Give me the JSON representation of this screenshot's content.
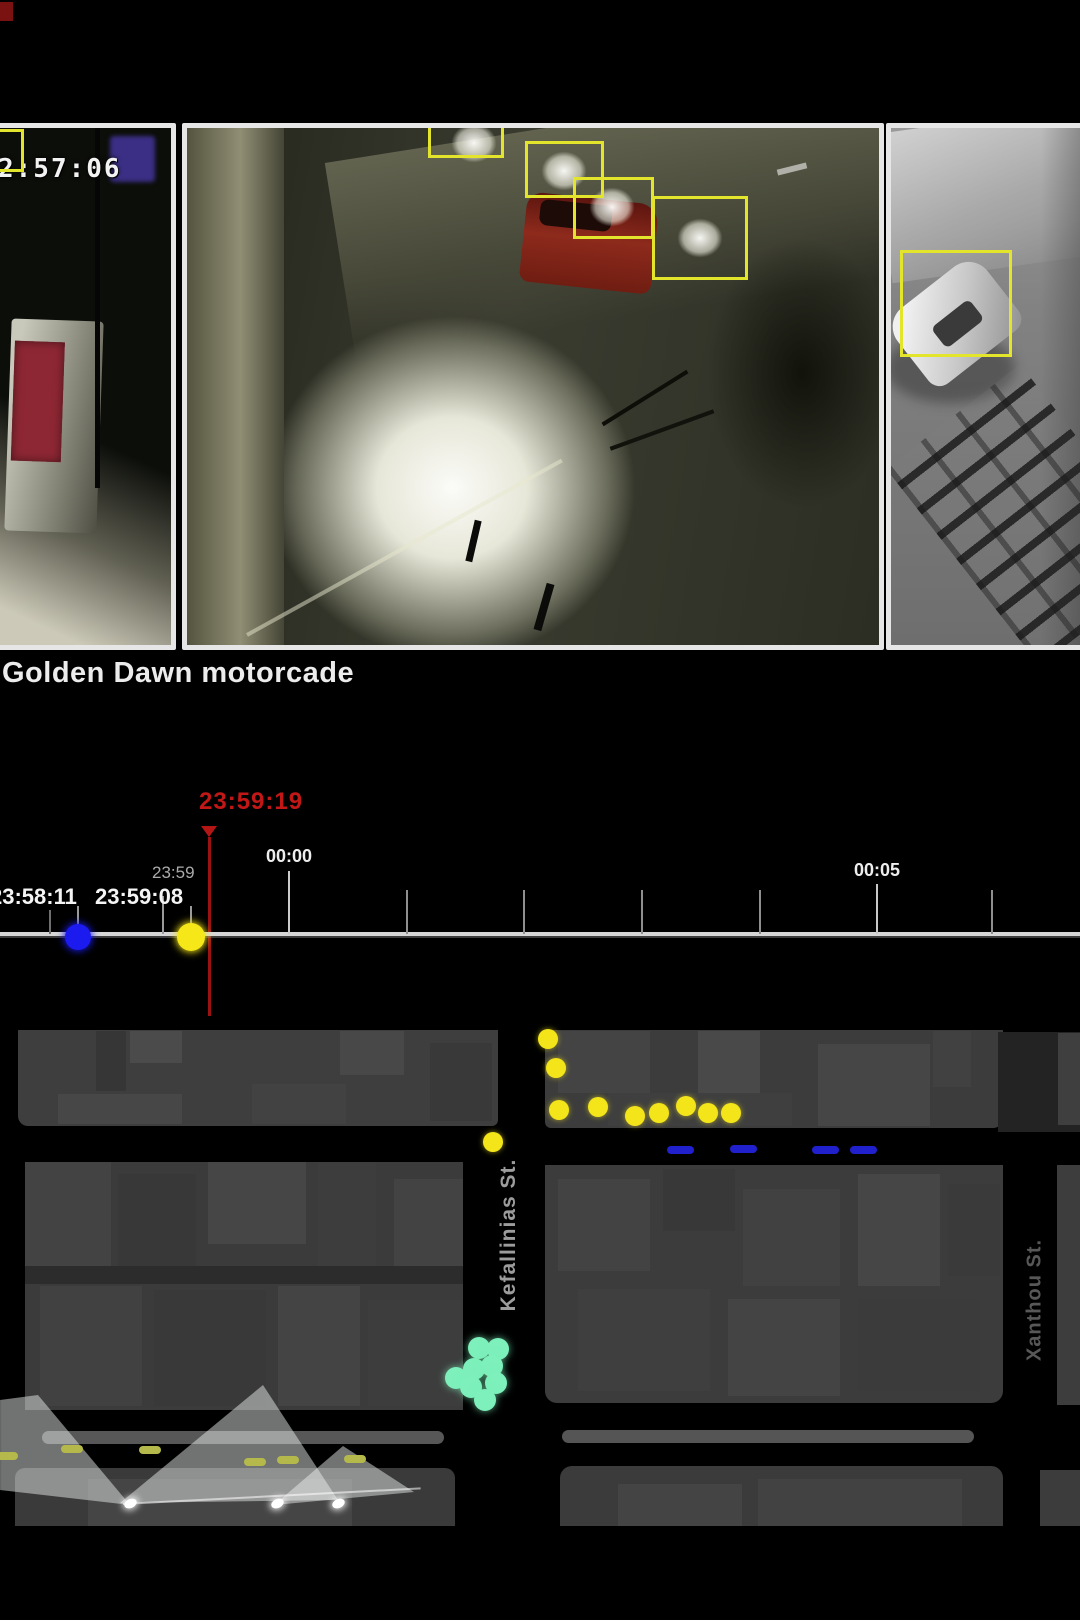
{
  "colors": {
    "detection_box": "#e3e42c",
    "cursor_red": "#c21717",
    "timeline_line": "#d6d6d6",
    "event_blue": "#1b1bf0",
    "event_yellow": "#f5e718",
    "map_yellow": "#f3e51a",
    "map_blue_dash": "#2020cc",
    "map_green": "#7df0bb",
    "map_olive_dash": "#b5b94c"
  },
  "video_strip": {
    "caption": "Golden Dawn motorcade",
    "frames": [
      {
        "name": "cctv-frame-1",
        "rect": [
          -10,
          123,
          186,
          527
        ],
        "timestamp_overlay": "2:57:06",
        "boxes": [
          {
            "x": -36,
            "y": 129,
            "w": 60,
            "h": 43
          }
        ]
      },
      {
        "name": "cctv-frame-2",
        "rect": [
          182,
          123,
          702,
          527
        ],
        "timestamp_overlay": "",
        "boxes": [
          {
            "x": 428,
            "y": 116,
            "w": 76,
            "h": 42
          },
          {
            "x": 525,
            "y": 141,
            "w": 79,
            "h": 57
          },
          {
            "x": 573,
            "y": 177,
            "w": 81,
            "h": 62
          },
          {
            "x": 652,
            "y": 196,
            "w": 96,
            "h": 84
          }
        ]
      },
      {
        "name": "cctv-frame-3",
        "rect": [
          886,
          123,
          200,
          527
        ],
        "timestamp_overlay": "",
        "boxes": [
          {
            "x": 900,
            "y": 250,
            "w": 112,
            "h": 107
          }
        ]
      }
    ]
  },
  "timeline": {
    "cursor_time": "23:59:19",
    "cursor_x": 209,
    "cursor_text_left": 199,
    "cursor_text_top": 788,
    "cursor_tri_left": 201,
    "cursor_tri_top": 826,
    "cursor_line_top": 837,
    "cursor_line_bottom": 1016,
    "minor_label": {
      "text": "23:59",
      "left": 152,
      "top": 863
    },
    "axis_labels": [
      {
        "text": "00:00",
        "x": 289,
        "top": 846
      },
      {
        "text": "00:05",
        "x": 877,
        "top": 860
      }
    ],
    "ticks": [
      {
        "x": 50,
        "top": 910,
        "h": 24,
        "c": "#6f6f6f"
      },
      {
        "x": 163,
        "top": 896,
        "h": 38,
        "c": "#9a9a9a"
      },
      {
        "x": 289,
        "top": 871,
        "h": 63,
        "c": "#cccccc"
      },
      {
        "x": 407,
        "top": 890,
        "h": 44,
        "c": "#8f8f8f"
      },
      {
        "x": 524,
        "top": 890,
        "h": 44,
        "c": "#8f8f8f"
      },
      {
        "x": 642,
        "top": 890,
        "h": 44,
        "c": "#8f8f8f"
      },
      {
        "x": 760,
        "top": 890,
        "h": 44,
        "c": "#8f8f8f"
      },
      {
        "x": 877,
        "top": 884,
        "h": 50,
        "c": "#c8c8c8"
      },
      {
        "x": 992,
        "top": 890,
        "h": 44,
        "c": "#8f8f8f"
      }
    ],
    "events": [
      {
        "time": "23:58:11",
        "label_left": -10,
        "label_top": 884,
        "conn_x": 77,
        "dot_cx": 78,
        "dot_cy": 937,
        "dot_r": 13,
        "color": "#1b1bf0"
      },
      {
        "time": "23:59:08",
        "label_left": 95,
        "label_top": 884,
        "conn_x": 190,
        "dot_cx": 191,
        "dot_cy": 937,
        "dot_r": 14,
        "color": "#f5e718"
      }
    ]
  },
  "map": {
    "street_labels": [
      {
        "text": "Kefallinias St.",
        "x": 509,
        "y": 1235,
        "color": "#9c9c9c",
        "size": 21
      },
      {
        "text": "Xanthou St.",
        "x": 1035,
        "y": 1300,
        "color": "#585858",
        "size": 20
      }
    ],
    "buildings": [
      [
        18,
        1030,
        480,
        96,
        "#3e3e3e",
        "0 0 6px 10px"
      ],
      [
        96,
        1031,
        30,
        60,
        "#363636"
      ],
      [
        130,
        1031,
        52,
        32,
        "#4b4b4b"
      ],
      [
        340,
        1031,
        64,
        44,
        "#484848"
      ],
      [
        58,
        1094,
        124,
        30,
        "#474747"
      ],
      [
        252,
        1084,
        94,
        40,
        "#424242"
      ],
      [
        430,
        1043,
        62,
        78,
        "#393939"
      ],
      [
        545,
        1030,
        458,
        98,
        "#3c3c3c",
        "0 0 10px 6px"
      ],
      [
        558,
        1031,
        92,
        62,
        "#444444"
      ],
      [
        698,
        1031,
        62,
        72,
        "#494949"
      ],
      [
        818,
        1044,
        112,
        82,
        "#464646"
      ],
      [
        933,
        1031,
        38,
        56,
        "#414141"
      ],
      [
        608,
        1093,
        184,
        33,
        "#3f3f3f"
      ],
      [
        998,
        1032,
        82,
        100,
        "trees"
      ],
      [
        1058,
        1033,
        22,
        92,
        "#3f3f3f"
      ],
      [
        25,
        1162,
        438,
        248,
        "#3b3b3b",
        "10px 0 0 0"
      ],
      [
        25,
        1162,
        86,
        106,
        "#434343"
      ],
      [
        118,
        1174,
        78,
        94,
        "#383838"
      ],
      [
        208,
        1162,
        98,
        82,
        "#464646"
      ],
      [
        318,
        1162,
        58,
        106,
        "#3d3d3d"
      ],
      [
        394,
        1179,
        69,
        88,
        "#434343"
      ],
      [
        25,
        1266,
        438,
        18,
        "#2c2c2c"
      ],
      [
        40,
        1286,
        102,
        120,
        "#414141"
      ],
      [
        154,
        1290,
        112,
        116,
        "#393939"
      ],
      [
        278,
        1286,
        82,
        120,
        "#444444"
      ],
      [
        368,
        1300,
        95,
        106,
        "#3d3d3d"
      ],
      [
        545,
        1165,
        458,
        238,
        "#3c3c3c",
        "0 0 12px 12px"
      ],
      [
        558,
        1179,
        92,
        92,
        "#434343"
      ],
      [
        663,
        1169,
        72,
        62,
        "#383838"
      ],
      [
        743,
        1189,
        97,
        97,
        "#414141"
      ],
      [
        858,
        1174,
        82,
        112,
        "#464646"
      ],
      [
        948,
        1184,
        52,
        92,
        "#3a3a3a"
      ],
      [
        578,
        1289,
        132,
        102,
        "#3f3f3f"
      ],
      [
        728,
        1299,
        112,
        97,
        "#444444"
      ],
      [
        858,
        1299,
        122,
        92,
        "#3b3b3b"
      ],
      [
        1057,
        1165,
        23,
        240,
        "#3d3d3d"
      ],
      [
        15,
        1468,
        440,
        58,
        "#3a3a3a",
        "10px 10px 0 0"
      ],
      [
        88,
        1479,
        264,
        47,
        "#454545"
      ],
      [
        560,
        1466,
        443,
        60,
        "#3b3b3b",
        "12px 12px 0 0"
      ],
      [
        618,
        1484,
        124,
        42,
        "#444444"
      ],
      [
        758,
        1479,
        204,
        47,
        "#424242"
      ],
      [
        1040,
        1470,
        40,
        56,
        "#3c3c3c"
      ]
    ],
    "medians": [
      [
        42,
        1431,
        402,
        13,
        "#575757"
      ],
      [
        562,
        1430,
        412,
        13,
        "#555555"
      ]
    ],
    "yellow_dots": [
      [
        548,
        1039
      ],
      [
        556,
        1068
      ],
      [
        559,
        1110
      ],
      [
        598,
        1107
      ],
      [
        635,
        1116
      ],
      [
        659,
        1113
      ],
      [
        686,
        1106
      ],
      [
        708,
        1113
      ],
      [
        731,
        1113
      ],
      [
        493,
        1142
      ]
    ],
    "blue_dashes": [
      [
        667,
        1146
      ],
      [
        730,
        1145
      ],
      [
        812,
        1146
      ],
      [
        850,
        1146
      ]
    ],
    "green_dots": [
      [
        479,
        1348
      ],
      [
        498,
        1349
      ],
      [
        474,
        1369
      ],
      [
        492,
        1366
      ],
      [
        456,
        1378
      ],
      [
        496,
        1383
      ],
      [
        471,
        1387
      ],
      [
        485,
        1400
      ]
    ],
    "olive_dashes": [
      [
        -4,
        1452
      ],
      [
        61,
        1445
      ],
      [
        139,
        1446
      ],
      [
        244,
        1458
      ],
      [
        277,
        1456
      ],
      [
        344,
        1455
      ]
    ],
    "cones": [
      {
        "points": "130px 1505px, 38px 1395px, 0px 1400px, 0px 1490px"
      },
      {
        "points": "263px 1385px, 120px 1503px, 338px 1500px"
      },
      {
        "points": "343px 1446px, 274px 1505px, 414px 1492px"
      }
    ],
    "cone_base_line": {
      "x": 123,
      "y": 1503,
      "len": 298,
      "angle": -3
    },
    "cameras": [
      [
        130,
        1503
      ],
      [
        277,
        1503
      ],
      [
        338,
        1503
      ]
    ]
  }
}
